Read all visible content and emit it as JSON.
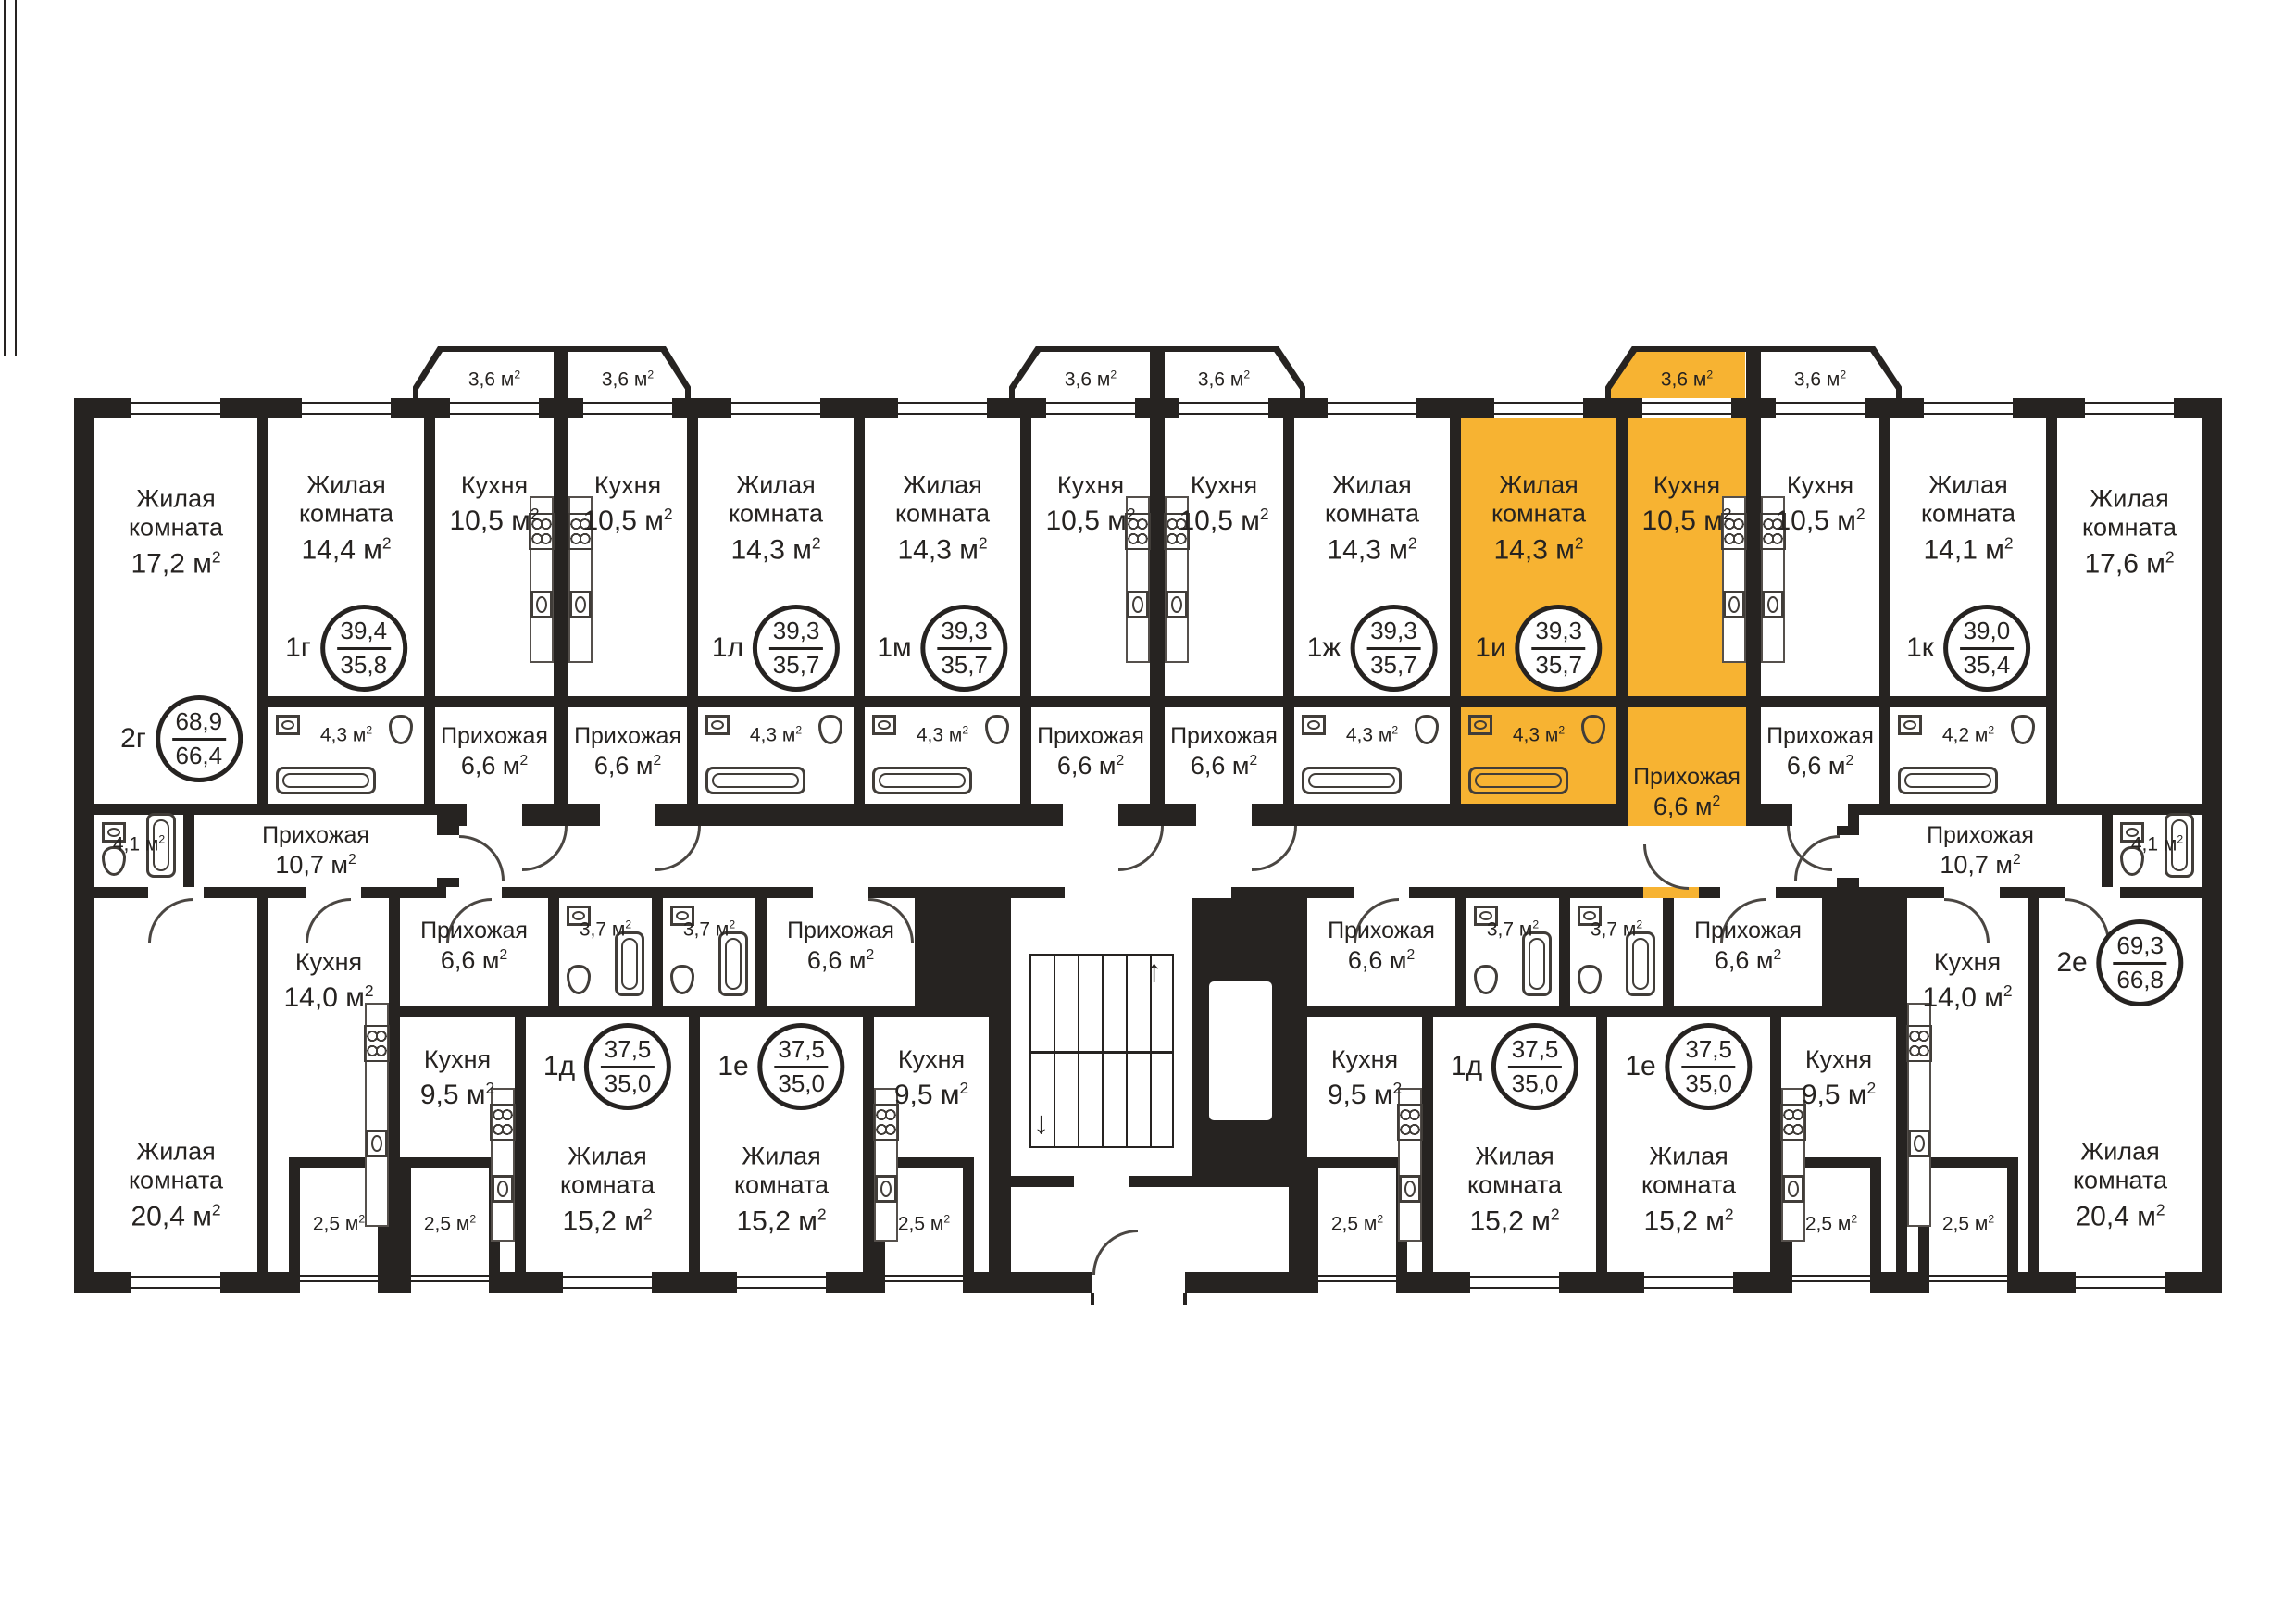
{
  "plan": {
    "highlight_color": "#f7b332",
    "wall_color": "#262321",
    "background": "#ffffff"
  },
  "units": {
    "area_letter": "м",
    "sup": "2"
  },
  "icons": {
    "stairs_up_arrow": "↑",
    "stairs_down_arrow": "↓"
  },
  "circles": [
    {
      "id": "c-2g",
      "apt": "2г",
      "total": "68,9",
      "living": "66,4"
    },
    {
      "id": "c-1g",
      "apt": "1г",
      "total": "39,4",
      "living": "35,8"
    },
    {
      "id": "c-1l",
      "apt": "1л",
      "total": "39,3",
      "living": "35,7"
    },
    {
      "id": "c-1m",
      "apt": "1м",
      "total": "39,3",
      "living": "35,7"
    },
    {
      "id": "c-1zh",
      "apt": "1ж",
      "total": "39,3",
      "living": "35,7"
    },
    {
      "id": "c-1i",
      "apt": "1и",
      "total": "39,3",
      "living": "35,7"
    },
    {
      "id": "c-1k",
      "apt": "1к",
      "total": "39,0",
      "living": "35,4"
    },
    {
      "id": "c-2e",
      "apt": "2е",
      "total": "69,3",
      "living": "66,8"
    },
    {
      "id": "c-1d-left",
      "apt": "1д",
      "total": "37,5",
      "living": "35,0"
    },
    {
      "id": "c-1e-left",
      "apt": "1е",
      "total": "37,5",
      "living": "35,0"
    },
    {
      "id": "c-1d-right",
      "apt": "1д",
      "total": "37,5",
      "living": "35,0"
    },
    {
      "id": "c-1e-right",
      "apt": "1е",
      "total": "37,5",
      "living": "35,0"
    }
  ],
  "rooms": [
    {
      "id": "r-liv-2g-17-2",
      "name": "Жилая комната",
      "area": "17,2",
      "kind": "room"
    },
    {
      "id": "r-liv-1g-14-4",
      "name": "Жилая комната",
      "area": "14,4",
      "kind": "room"
    },
    {
      "id": "r-kit-1g",
      "name": "Кухня",
      "area": "10,5",
      "kind": "room"
    },
    {
      "id": "r-kit-1l",
      "name": "Кухня",
      "area": "10,5",
      "kind": "room"
    },
    {
      "id": "r-liv-1l-14-3",
      "name": "Жилая комната",
      "area": "14,3",
      "kind": "room"
    },
    {
      "id": "r-liv-1m-14-3",
      "name": "Жилая комната",
      "area": "14,3",
      "kind": "room"
    },
    {
      "id": "r-kit-1m",
      "name": "Кухня",
      "area": "10,5",
      "kind": "room"
    },
    {
      "id": "r-kit-1zh",
      "name": "Кухня",
      "area": "10,5",
      "kind": "room"
    },
    {
      "id": "r-liv-1zh-14-3",
      "name": "Жилая комната",
      "area": "14,3",
      "kind": "room"
    },
    {
      "id": "r-liv-1i-14-3",
      "name": "Жилая комната",
      "area": "14,3",
      "kind": "room",
      "highlighted": true
    },
    {
      "id": "r-kit-1i",
      "name": "Кухня",
      "area": "10,5",
      "kind": "room",
      "highlighted": true
    },
    {
      "id": "r-kit-1k",
      "name": "Кухня",
      "area": "10,5",
      "kind": "room"
    },
    {
      "id": "r-liv-1k-14-1",
      "name": "Жилая комната",
      "area": "14,1",
      "kind": "room"
    },
    {
      "id": "r-liv-2e-17-6",
      "name": "Жилая комната",
      "area": "17,6",
      "kind": "room"
    },
    {
      "id": "r-bath-1g",
      "name": "",
      "area": "4,3",
      "kind": "small"
    },
    {
      "id": "r-pr-1g",
      "name": "Прихожая",
      "area": "6,6",
      "kind": "room"
    },
    {
      "id": "r-pr-1l",
      "name": "Прихожая",
      "area": "6,6",
      "kind": "room"
    },
    {
      "id": "r-bath-1l",
      "name": "",
      "area": "4,3",
      "kind": "small"
    },
    {
      "id": "r-bath-1m",
      "name": "",
      "area": "4,3",
      "kind": "small"
    },
    {
      "id": "r-pr-1m",
      "name": "Прихожая",
      "area": "6,6",
      "kind": "room"
    },
    {
      "id": "r-pr-1zh",
      "name": "Прихожая",
      "area": "6,6",
      "kind": "room"
    },
    {
      "id": "r-bath-1zh",
      "name": "",
      "area": "4,3",
      "kind": "small"
    },
    {
      "id": "r-bath-1i",
      "name": "",
      "area": "4,3",
      "kind": "small",
      "highlighted": true
    },
    {
      "id": "r-pr-1i",
      "name": "Прихожая",
      "area": "6,6",
      "kind": "room",
      "highlighted": true
    },
    {
      "id": "r-pr-1k",
      "name": "Прихожая",
      "area": "6,6",
      "kind": "room"
    },
    {
      "id": "r-bath-1k",
      "name": "",
      "area": "4,2",
      "kind": "small"
    },
    {
      "id": "r-bath-2g",
      "name": "",
      "area": "4,1",
      "kind": "small"
    },
    {
      "id": "r-pr-2g",
      "name": "Прихожая",
      "area": "10,7",
      "kind": "room"
    },
    {
      "id": "r-pr-2e",
      "name": "Прихожая",
      "area": "10,7",
      "kind": "room"
    },
    {
      "id": "r-bath-2e",
      "name": "",
      "area": "4,1",
      "kind": "small"
    },
    {
      "id": "r-liv-2g-20-4",
      "name": "Жилая комната",
      "area": "20,4",
      "kind": "room"
    },
    {
      "id": "r-kit-2g-14-0",
      "name": "Кухня",
      "area": "14,0",
      "kind": "room"
    },
    {
      "id": "r-pr-1dL",
      "name": "Прихожая",
      "area": "6,6",
      "kind": "room"
    },
    {
      "id": "r-bath-1dL",
      "name": "",
      "area": "3,7",
      "kind": "small"
    },
    {
      "id": "r-kit-1dL",
      "name": "Кухня",
      "area": "9,5",
      "kind": "room"
    },
    {
      "id": "r-liv-1dL",
      "name": "Жилая комната",
      "area": "15,2",
      "kind": "room"
    },
    {
      "id": "r-bath-1eL",
      "name": "",
      "area": "3,7",
      "kind": "small"
    },
    {
      "id": "r-pr-1eL",
      "name": "Прихожая",
      "area": "6,6",
      "kind": "room"
    },
    {
      "id": "r-liv-1eL",
      "name": "Жилая комната",
      "area": "15,2",
      "kind": "room"
    },
    {
      "id": "r-kit-1eL",
      "name": "Кухня",
      "area": "9,5",
      "kind": "room"
    },
    {
      "id": "r-pr-1dR",
      "name": "Прихожая",
      "area": "6,6",
      "kind": "room"
    },
    {
      "id": "r-bath-1dR",
      "name": "",
      "area": "3,7",
      "kind": "small"
    },
    {
      "id": "r-kit-1dR",
      "name": "Кухня",
      "area": "9,5",
      "kind": "room"
    },
    {
      "id": "r-liv-1dR",
      "name": "Жилая комната",
      "area": "15,2",
      "kind": "room"
    },
    {
      "id": "r-bath-1eR",
      "name": "",
      "area": "3,7",
      "kind": "small"
    },
    {
      "id": "r-pr-1eR",
      "name": "Прихожая",
      "area": "6,6",
      "kind": "room"
    },
    {
      "id": "r-liv-1eR",
      "name": "Жилая комната",
      "area": "15,2",
      "kind": "room"
    },
    {
      "id": "r-kit-1eR",
      "name": "Кухня",
      "area": "9,5",
      "kind": "room"
    },
    {
      "id": "r-kit-2e-14-0",
      "name": "Кухня",
      "area": "14,0",
      "kind": "room"
    },
    {
      "id": "r-liv-2e-20-4",
      "name": "Жилая комната",
      "area": "20,4",
      "kind": "room"
    },
    {
      "id": "bal-t1a",
      "name": "",
      "area": "3,6",
      "kind": "balcony"
    },
    {
      "id": "bal-t1b",
      "name": "",
      "area": "3,6",
      "kind": "balcony"
    },
    {
      "id": "bal-t2a",
      "name": "",
      "area": "3,6",
      "kind": "balcony"
    },
    {
      "id": "bal-t2b",
      "name": "",
      "area": "3,6",
      "kind": "balcony"
    },
    {
      "id": "bal-t3a",
      "name": "",
      "area": "3,6",
      "kind": "balcony",
      "highlighted": true
    },
    {
      "id": "bal-t3b",
      "name": "",
      "area": "3,6",
      "kind": "balcony"
    },
    {
      "id": "bal-b1",
      "name": "",
      "area": "2,5",
      "kind": "balcony"
    },
    {
      "id": "bal-b2",
      "name": "",
      "area": "2,5",
      "kind": "balcony"
    },
    {
      "id": "bal-b3",
      "name": "",
      "area": "2,5",
      "kind": "balcony"
    },
    {
      "id": "bal-b4",
      "name": "",
      "area": "2,5",
      "kind": "balcony"
    },
    {
      "id": "bal-b5",
      "name": "",
      "area": "2,5",
      "kind": "balcony"
    },
    {
      "id": "bal-b6",
      "name": "",
      "area": "2,5",
      "kind": "balcony"
    }
  ]
}
